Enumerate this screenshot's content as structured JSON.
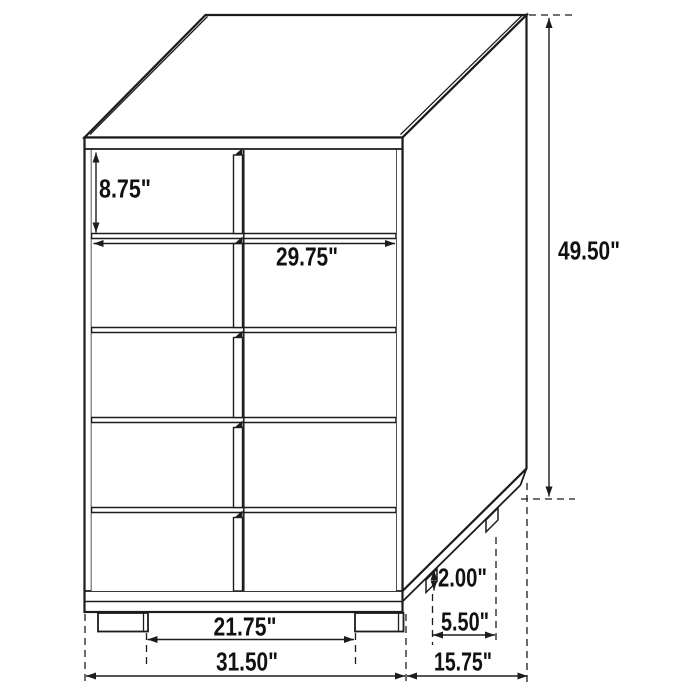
{
  "drawing": {
    "type": "furniture-dimension-diagram",
    "item": "5-drawer chest",
    "drawer_count": 5,
    "line_color": "#1c1c1c",
    "background_color": "#ffffff"
  },
  "dimensions": {
    "drawer_face_height": "8.75\"",
    "drawer_width": "29.75\"",
    "overall_height": "49.50\"",
    "leg_height": "2.00\"",
    "rear_leg_spacing_depth": "5.50\"",
    "front_leg_spacing_width": "21.75\"",
    "overall_width": "31.50\"",
    "overall_depth": "15.75\""
  }
}
